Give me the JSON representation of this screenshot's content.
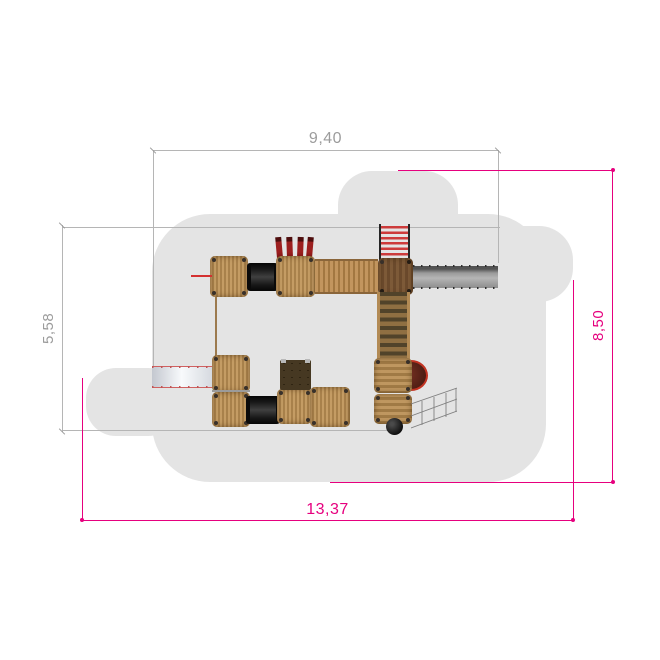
{
  "dimensions": {
    "top": {
      "label": "9,40",
      "color": "#9c9c9c"
    },
    "left": {
      "label": "5,58",
      "color": "#9c9c9c"
    },
    "right": {
      "label": "8,50",
      "color": "#e6007e"
    },
    "bottom": {
      "label": "13,37",
      "color": "#e6007e"
    }
  },
  "colors": {
    "dimension_gray": "#b5b5b5",
    "dimension_magenta": "#e6007e",
    "safety_zone": "#e4e4e4",
    "wood_light": "#b98e56",
    "wood_dark": "#7d5a38",
    "tunnel_black": "#141414",
    "accent_red": "#cc2a2a",
    "slide_gray": "#9a9a9a",
    "slide_white": "#f4f6f8",
    "panel_olive": "#463822",
    "table_maroon": "#531d13"
  },
  "parts": [
    "safety-zone",
    "wooden-platform",
    "crawl-tunnel",
    "climbing-posts",
    "plank-bridge",
    "rung-ladder",
    "steel-slide",
    "white-slide",
    "stair-flight",
    "firemans-pole",
    "activity-panel",
    "play-table",
    "balance-ball",
    "climbing-net"
  ]
}
